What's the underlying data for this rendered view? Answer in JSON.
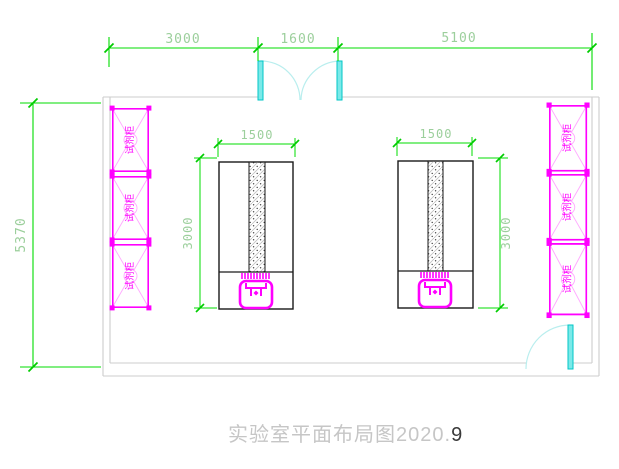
{
  "drawing": {
    "title": {
      "main": "实验室平面布局图2020.",
      "suffix": "9"
    },
    "dimensions": {
      "top_segments": [
        "3000",
        "1600",
        "5100"
      ],
      "room_height": "5370",
      "bench_left": {
        "width": "1500",
        "depth": "3000"
      },
      "bench_right": {
        "width": "1500",
        "depth": "3000"
      }
    },
    "cabinets": {
      "left": [
        "试剂柜",
        "试剂柜",
        "试剂柜"
      ],
      "right": [
        "试剂柜",
        "试剂柜",
        "试剂柜"
      ]
    },
    "colors": {
      "dimension_line": "#00dd00",
      "dimension_text": "#9ccf9c",
      "wall": "#cccccc",
      "furniture_magenta": "#ff00ff",
      "furniture_pink": "#ffaaff",
      "door_leaf": "#7be9e9",
      "door_edge": "#00c6c6",
      "door_arc": "#b9eeee",
      "bench_outline": "#1a1a1a",
      "title_text": "#c6c6c6"
    }
  }
}
